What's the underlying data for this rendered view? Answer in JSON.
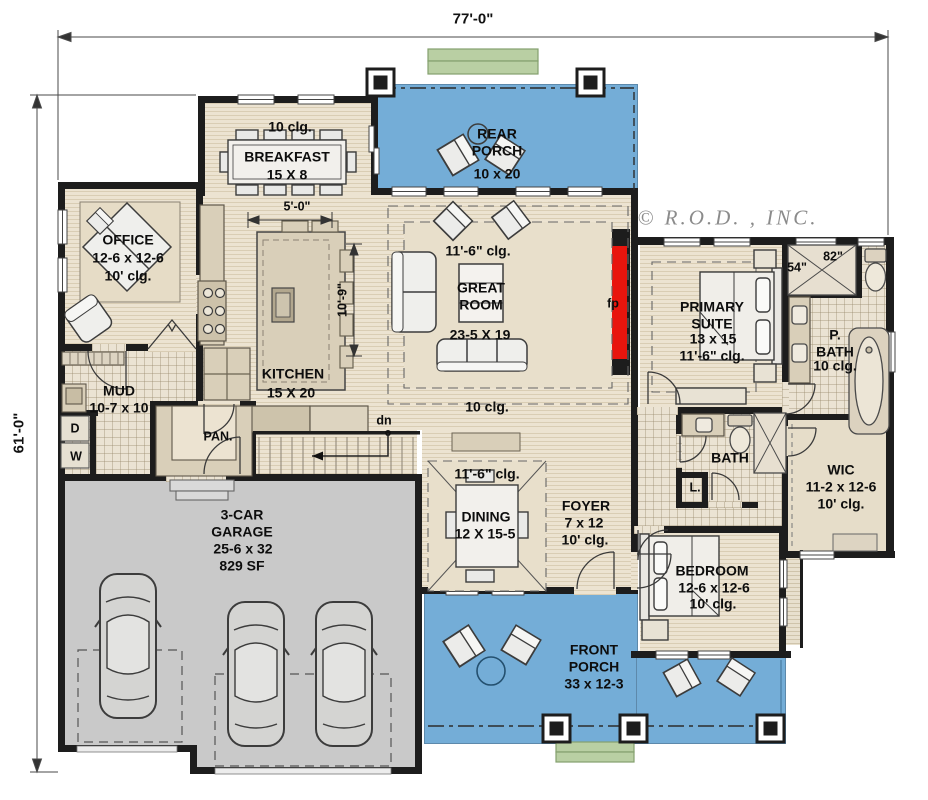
{
  "dimensions": {
    "width_overall": "77'-0\"",
    "depth_overall": "61'-0\""
  },
  "copyright": "© R.O.D. , INC.",
  "rooms": {
    "rear_porch": {
      "name": "REAR\nPORCH",
      "size": "10 x 20"
    },
    "breakfast": {
      "ceiling": "10 clg.",
      "name": "BREAKFAST",
      "size": "15 X 8"
    },
    "office": {
      "name": "OFFICE",
      "size": "12-6 x 12-6",
      "ceiling": "10' clg."
    },
    "great_room": {
      "ceiling": "11'-6\" clg.",
      "name": "GREAT\nROOM",
      "size": "23-5 X 19"
    },
    "kitchen": {
      "name": "KITCHEN",
      "size": "15 X 20"
    },
    "mud": {
      "name": "MUD",
      "size": "10-7 x 10"
    },
    "pantry": {
      "name": "PAN."
    },
    "dining": {
      "ceiling": "11'-6\" clg.",
      "name": "DINING",
      "size": "12 X 15-5"
    },
    "foyer": {
      "name": "FOYER",
      "size": "7 x 12",
      "ceiling": "10' clg."
    },
    "garage": {
      "name": "3-CAR\nGARAGE",
      "size": "25-6 x 32",
      "area": "829 SF"
    },
    "primary_suite": {
      "name": "PRIMARY\nSUITE",
      "size": "13 x 15",
      "ceiling": "11'-6\" clg."
    },
    "primary_bath": {
      "name": "P.\nBATH",
      "ceiling": "10 clg.",
      "shower_depth": "54\"",
      "shower_width": "82\""
    },
    "bath": {
      "name": "BATH"
    },
    "linen": {
      "name": "L."
    },
    "wic": {
      "name": "WIC",
      "size": "11-2 x 12-6",
      "ceiling": "10' clg."
    },
    "bedroom": {
      "name": "BEDROOM",
      "size": "12-6 x 12-6",
      "ceiling": "10' clg."
    },
    "front_porch": {
      "name": "FRONT\nPORCH",
      "size": "33 x 12-3"
    }
  },
  "annotations": {
    "stairs_down": "dn",
    "dryer": "D",
    "washer": "W",
    "fireplace": "fp",
    "hall_ceiling": "10 clg.",
    "island_width": "5'-0\"",
    "island_length": "10'-9\""
  },
  "colors": {
    "porch": "#74add7",
    "wood": "#ece3d1",
    "wood_stripe": "#d9cdb4",
    "tile": "#ebe3d3",
    "garage": "#c9c9c9",
    "wall": "#1d1d1d",
    "fireplace": "#e8150d",
    "steps": "#b9cfa3"
  }
}
